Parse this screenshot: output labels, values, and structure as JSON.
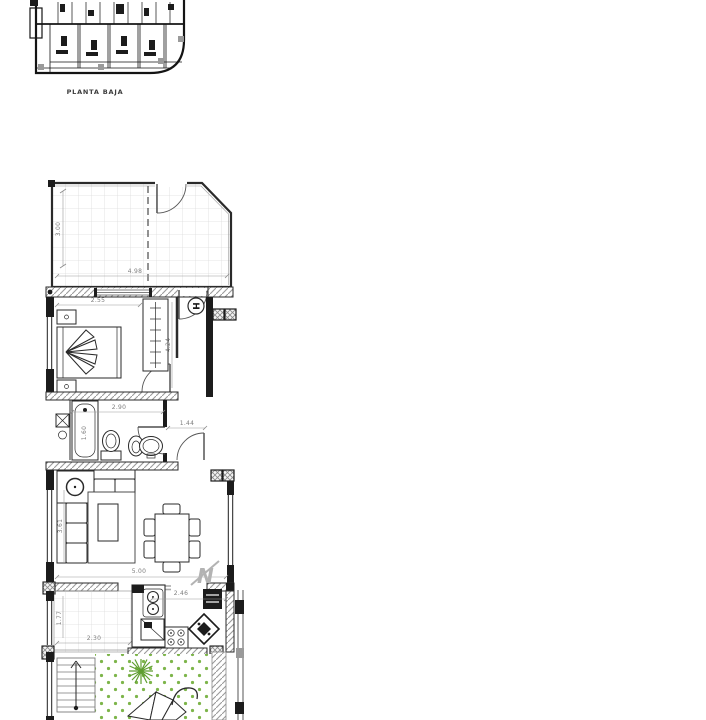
{
  "site_plan": {
    "label": "PLANTA BAJA"
  },
  "plan": {
    "entrance_label": "H",
    "north_label": "N",
    "dims": {
      "terrace_depth": "3.00",
      "terrace_width": "4.98",
      "bedroom_width": "2.55",
      "bedroom_length": "4.24",
      "bathroom_width": "2.90",
      "bathtub_length": "1.60",
      "hall_width": "1.44",
      "living_width": "5.00",
      "living_depth": "3.61",
      "kitchen_width": "2.46",
      "patio_width": "2.30",
      "patio_depth": "1.77"
    },
    "colors": {
      "wall": "#1c1c1c",
      "wall_hatch": "#9b9b9b",
      "dimension_text": "#7d7d7d",
      "tile_grid": "#dcdcdc",
      "grass_dot": "#7db54a",
      "plant_green": "#5f9e30"
    }
  }
}
